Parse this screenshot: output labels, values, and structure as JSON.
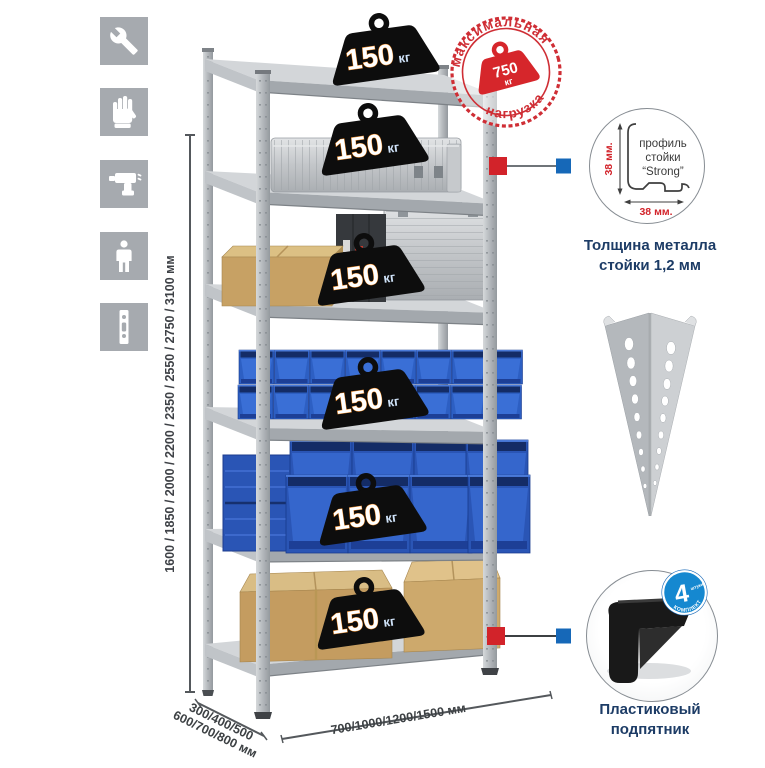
{
  "colors": {
    "accent_red": "#d2232a",
    "accent_blue": "#1668b8",
    "stamp_red": "#cf2e35",
    "bin_blue": "#2d5fc3",
    "navy_text": "#1d3c66",
    "metal_gray": "#b9bdc2",
    "icon_tile_gray": "#a6aaaf"
  },
  "left_toolbar": {
    "icons": [
      {
        "name": "wrench-icon"
      },
      {
        "name": "gloves-icon"
      },
      {
        "name": "drill-icon"
      },
      {
        "name": "person-icon"
      },
      {
        "name": "rack-post-icon"
      }
    ]
  },
  "height_dimension": {
    "label": "1600 / 1850 / 2000 / 2200 / 2350 / 2550 / 2750 / 3100 мм"
  },
  "rack": {
    "shelf_count": 6,
    "badges": [
      {
        "value": "150",
        "unit": "кг"
      },
      {
        "value": "150",
        "unit": "кг"
      },
      {
        "value": "150",
        "unit": "кг"
      },
      {
        "value": "150",
        "unit": "кг"
      },
      {
        "value": "150",
        "unit": "кг"
      },
      {
        "value": "150",
        "unit": "кг"
      }
    ]
  },
  "max_load_stamp": {
    "arc_top": "максимальная",
    "arc_bottom": "нагрузка",
    "value": "750",
    "unit": "кг"
  },
  "profile_detail": {
    "labels": [
      "профиль",
      "стойки",
      "“Strong”"
    ],
    "dim_vertical": "38 мм.",
    "dim_horizontal": "38 мм.",
    "caption": [
      "Толщина металла",
      "стойки 1,2 мм"
    ]
  },
  "foot_detail": {
    "badge_value": "4",
    "badge_small": "штуки",
    "badge_arc": "В КОМПЛЕКТЕ",
    "caption": [
      "Пластиковый",
      "подпятник"
    ]
  },
  "base_dimensions": {
    "depth_line1": "300/400/500",
    "depth_line2": "600/700/800 мм",
    "width_label": "700/1000/1200/1500 мм"
  }
}
